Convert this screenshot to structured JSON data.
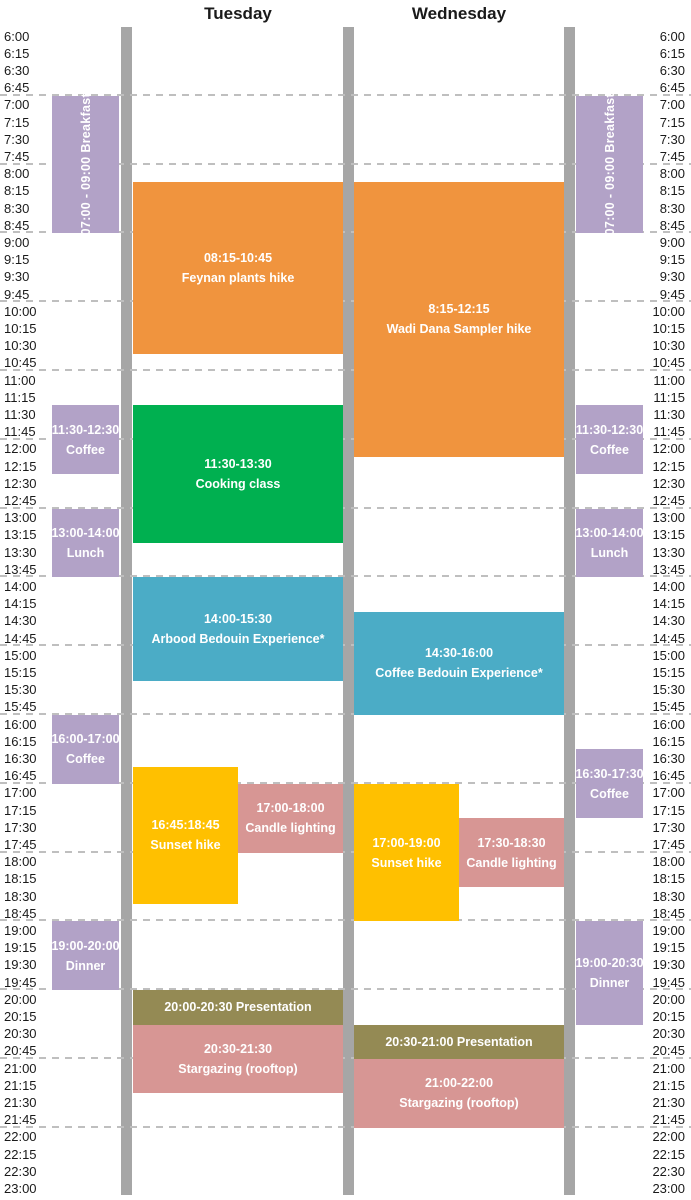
{
  "colors": {
    "orange": "#F0943E",
    "purple": "#B2A2C7",
    "green": "#00B050",
    "teal": "#4BACC6",
    "yellow": "#FFC000",
    "pink": "#D79694",
    "olive": "#948A54",
    "bar_gray": "#A6A6A6",
    "gridline_gray": "#BFBFBF",
    "text_dark": "#1A1A1A",
    "event_text": "#FFFFFF"
  },
  "chart_data": {
    "type": "table",
    "title": "Two-day activity schedule",
    "day_headers": [
      "Tuesday",
      "Wednesday"
    ],
    "time_axis": {
      "start": "6:00",
      "end": "23:00",
      "interval_minutes": 15,
      "tick_labels": [
        "6:00",
        "6:15",
        "6:30",
        "6:45",
        "7:00",
        "7:15",
        "7:30",
        "7:45",
        "8:00",
        "8:15",
        "8:30",
        "8:45",
        "9:00",
        "9:15",
        "9:30",
        "9:45",
        "10:00",
        "10:15",
        "10:30",
        "10:45",
        "11:00",
        "11:15",
        "11:30",
        "11:45",
        "12:00",
        "12:15",
        "12:30",
        "12:45",
        "13:00",
        "13:15",
        "13:30",
        "13:45",
        "14:00",
        "14:15",
        "14:30",
        "14:45",
        "15:00",
        "15:15",
        "15:30",
        "15:45",
        "16:00",
        "16:15",
        "16:30",
        "16:45",
        "17:00",
        "17:15",
        "17:30",
        "17:45",
        "18:00",
        "18:15",
        "18:30",
        "18:45",
        "19:00",
        "19:15",
        "19:30",
        "19:45",
        "20:00",
        "20:15",
        "20:30",
        "20:45",
        "21:00",
        "21:15",
        "21:30",
        "21:45",
        "22:00",
        "22:15",
        "22:30",
        "23:00"
      ]
    },
    "events": [
      {
        "area": "left_meals",
        "name": "breakfast",
        "color": "purple",
        "start": "7:00",
        "end": "9:00",
        "side": "full",
        "vertical": true,
        "lines": [
          "07:00 - 09:00 Breakfast"
        ]
      },
      {
        "area": "left_meals",
        "name": "coffee-morning",
        "color": "purple",
        "start": "11:30",
        "end": "12:30",
        "side": "full",
        "lines": [
          "11:30-12:30",
          "Coffee"
        ]
      },
      {
        "area": "left_meals",
        "name": "lunch",
        "color": "purple",
        "start": "13:00",
        "end": "14:00",
        "side": "full",
        "lines": [
          "13:00-14:00",
          "Lunch"
        ]
      },
      {
        "area": "left_meals",
        "name": "coffee-afternoon",
        "color": "purple",
        "start": "16:00",
        "end": "17:00",
        "side": "full",
        "lines": [
          "16:00-17:00",
          "Coffee"
        ]
      },
      {
        "area": "left_meals",
        "name": "dinner",
        "color": "purple",
        "start": "19:00",
        "end": "20:00",
        "side": "full",
        "lines": [
          "19:00-20:00",
          "Dinner"
        ]
      },
      {
        "area": "tuesday",
        "name": "feynan-plants-hike",
        "color": "orange",
        "start": "8:15",
        "end": "10:45",
        "side": "full",
        "lines": [
          "08:15-10:45",
          "Feynan plants hike"
        ]
      },
      {
        "area": "tuesday",
        "name": "cooking-class",
        "color": "green",
        "start": "11:30",
        "end": "13:30",
        "side": "full",
        "lines": [
          "11:30-13:30",
          "Cooking class"
        ]
      },
      {
        "area": "tuesday",
        "name": "arbood-bedouin-experience",
        "color": "teal",
        "start": "14:00",
        "end": "15:30",
        "side": "full",
        "lines": [
          "14:00-15:30",
          "Arbood Bedouin Experience*"
        ]
      },
      {
        "area": "tuesday",
        "name": "sunset-hike",
        "color": "yellow",
        "start": "16:45",
        "end": "18:45",
        "side": "left",
        "lines": [
          "16:45:18:45",
          "Sunset hike"
        ]
      },
      {
        "area": "tuesday",
        "name": "candle-lighting",
        "color": "pink",
        "start": "17:00",
        "end": "18:00",
        "side": "right",
        "lines": [
          "17:00-18:00",
          "Candle lighting"
        ]
      },
      {
        "area": "tuesday",
        "name": "presentation",
        "color": "olive",
        "start": "20:00",
        "end": "20:30",
        "side": "full",
        "lines": [
          "20:00-20:30 Presentation"
        ]
      },
      {
        "area": "tuesday",
        "name": "stargazing-rooftop",
        "color": "pink",
        "start": "20:30",
        "end": "21:30",
        "side": "full",
        "lines": [
          "20:30-21:30",
          "Stargazing (rooftop)"
        ]
      },
      {
        "area": "wednesday",
        "name": "wadi-dana-sampler-hike",
        "color": "orange",
        "start": "8:15",
        "end": "12:15",
        "side": "full",
        "lines": [
          "8:15-12:15",
          "Wadi Dana Sampler hike"
        ]
      },
      {
        "area": "wednesday",
        "name": "coffee-bedouin-experience",
        "color": "teal",
        "start": "14:30",
        "end": "16:00",
        "side": "full",
        "lines": [
          "14:30-16:00",
          "Coffee Bedouin Experience*"
        ]
      },
      {
        "area": "wednesday",
        "name": "sunset-hike",
        "color": "yellow",
        "start": "17:00",
        "end": "19:00",
        "side": "left",
        "lines": [
          "17:00-19:00",
          "Sunset hike"
        ]
      },
      {
        "area": "wednesday",
        "name": "candle-lighting",
        "color": "pink",
        "start": "17:30",
        "end": "18:30",
        "side": "right",
        "lines": [
          "17:30-18:30",
          "Candle lighting"
        ]
      },
      {
        "area": "wednesday",
        "name": "presentation",
        "color": "olive",
        "start": "20:30",
        "end": "21:00",
        "side": "full",
        "lines": [
          "20:30-21:00 Presentation"
        ]
      },
      {
        "area": "wednesday",
        "name": "stargazing-rooftop",
        "color": "pink",
        "start": "21:00",
        "end": "22:00",
        "side": "full",
        "lines": [
          "21:00-22:00",
          "Stargazing (rooftop)"
        ]
      },
      {
        "area": "right_meals",
        "name": "breakfast",
        "color": "purple",
        "start": "7:00",
        "end": "9:00",
        "side": "full",
        "vertical": true,
        "lines": [
          "07:00 - 09:00 Breakfast"
        ]
      },
      {
        "area": "right_meals",
        "name": "coffee-morning",
        "color": "purple",
        "start": "11:30",
        "end": "12:30",
        "side": "full",
        "lines": [
          "11:30-12:30",
          "Coffee"
        ]
      },
      {
        "area": "right_meals",
        "name": "lunch",
        "color": "purple",
        "start": "13:00",
        "end": "14:00",
        "side": "full",
        "lines": [
          "13:00-14:00",
          "Lunch"
        ]
      },
      {
        "area": "right_meals",
        "name": "coffee-afternoon",
        "color": "purple",
        "start": "16:30",
        "end": "17:30",
        "side": "full",
        "lines": [
          "16:30-17:30",
          "Coffee"
        ]
      },
      {
        "area": "right_meals",
        "name": "dinner",
        "color": "purple",
        "start": "19:00",
        "end": "20:30",
        "side": "full",
        "lines": [
          "19:00-20:30",
          "Dinner"
        ]
      }
    ]
  }
}
